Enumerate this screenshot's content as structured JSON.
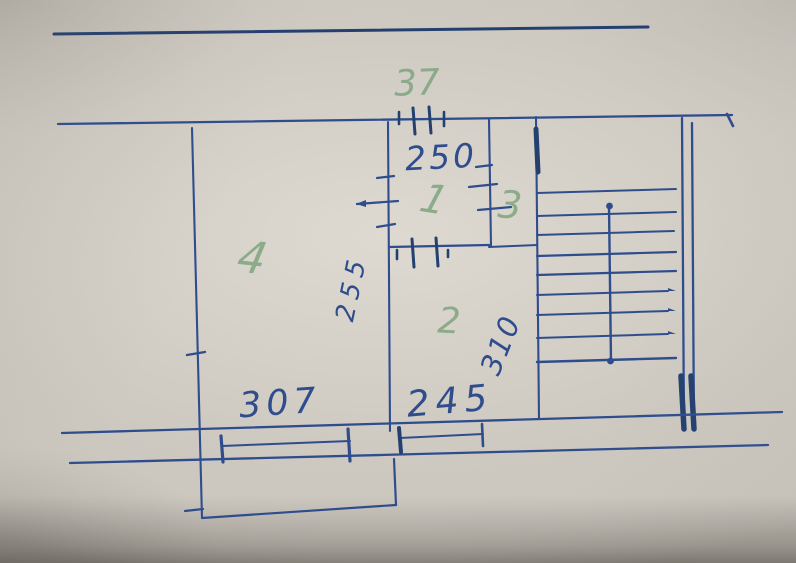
{
  "colors": {
    "ink": "#2f4d8d",
    "ink-dark": "#24406f",
    "ink-faint": "#5a76a8",
    "green": "#85a884",
    "paper": "#c9c5bd"
  },
  "labels": {
    "top_door_dim": "37",
    "hall_dim": "250",
    "room1": "1",
    "room2": "2",
    "room3": "3",
    "room4": "4",
    "stair_dim": "310",
    "wall_note": "255",
    "room4_dim": "307",
    "room2_dim": "245"
  }
}
